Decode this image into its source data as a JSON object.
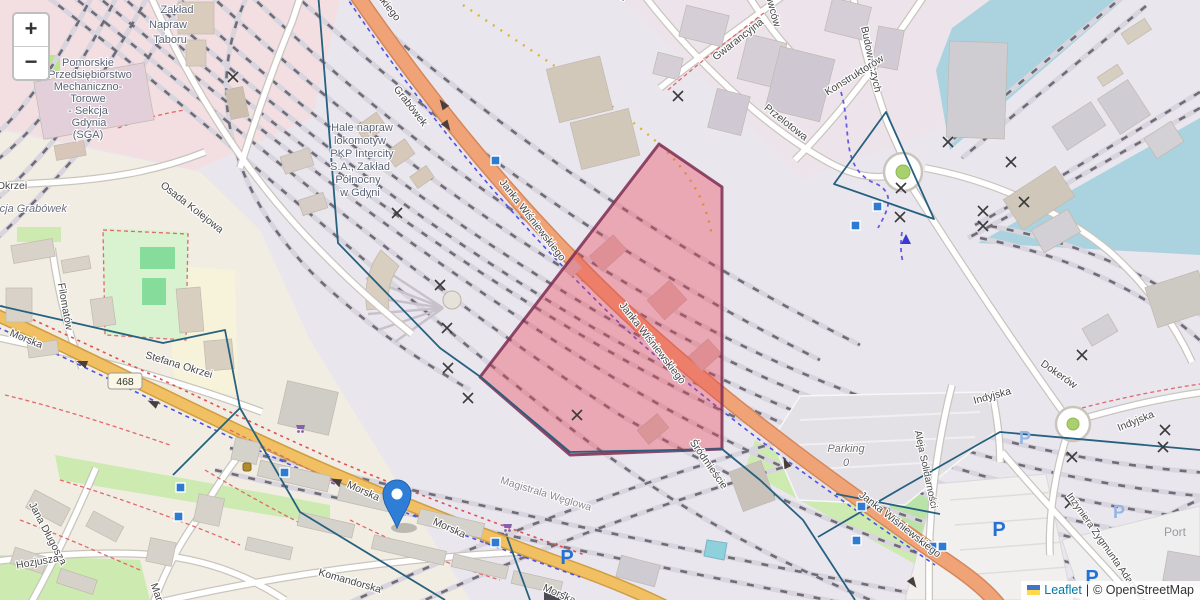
{
  "controls": {
    "zoom_in": "+",
    "zoom_out": "−"
  },
  "attribution": {
    "flag_icon": "ukraine-flag-icon",
    "leaflet_link": "Leaflet",
    "separator": "|",
    "osm_text": "© OpenStreetMap"
  },
  "icons": {
    "parking_letter": "P"
  },
  "marker": {
    "type": "blue-pin"
  },
  "route_badge": {
    "ref": "468"
  },
  "labels": {
    "zaklad_1": "Zakład",
    "zaklad_2": "Napraw",
    "zaklad_3": "Taboru",
    "pom_1": "Pomorskie",
    "pom_2": "Przedsiębiorstwo",
    "pom_3": "Mechaniczno-",
    "pom_4": "Torowe",
    "pom_5": "- Sekcja",
    "pom_6": "Gdynia",
    "pom_7": "(SGA)",
    "hale_1": "Hale napraw",
    "hale_2": "lokomotyw",
    "hale_3": "PKP Intercity",
    "hale_4": "S.A., Zakład",
    "hale_5": "Północny",
    "hale_6": "w Gdyni",
    "stacja": "Stacja Grabówek",
    "okrzei": "Okrzei",
    "osada": "Osada Kolejowa",
    "filomatow": "Filomatów",
    "grabowek": "Grabówek",
    "janka": "Janka Wiśniewskiego",
    "morska": "Morska",
    "stefana": "Stefana Okrzei",
    "magistrala": "Magistrala Węglowa",
    "komandorska": "Komandorska",
    "dlugosza": "Jana Długosza",
    "hozjusza": "Hozjusza",
    "maria": "Maria",
    "srodmiescie": "Śródmieście",
    "przelotowa": "Przelotowa",
    "gwarancyjna": "Gwarancyjna",
    "owcow": "owców",
    "budowniczych": "Budowniczych",
    "konstruktorow": "Konstruktorów",
    "dokerow": "Dokerów",
    "indyjska": "Indyjska",
    "aleja": "Aleja Solidarności",
    "parking": "Parking",
    "parking_zero": "0",
    "inzyniera": "Inżyniera Zygmunta Adamskiego",
    "port": "Port"
  },
  "colors": {
    "water": "#aad3df",
    "highlight_polygon_fill": "#ea4256",
    "highlight_polygon_stroke": "#7c2d52",
    "boundary_line": "#26617f",
    "road_primary": "#efa377",
    "road_secondary": "#f1c063",
    "marker_blue": "#2e7ed8",
    "parking_icon_blue": "#2570d4"
  }
}
